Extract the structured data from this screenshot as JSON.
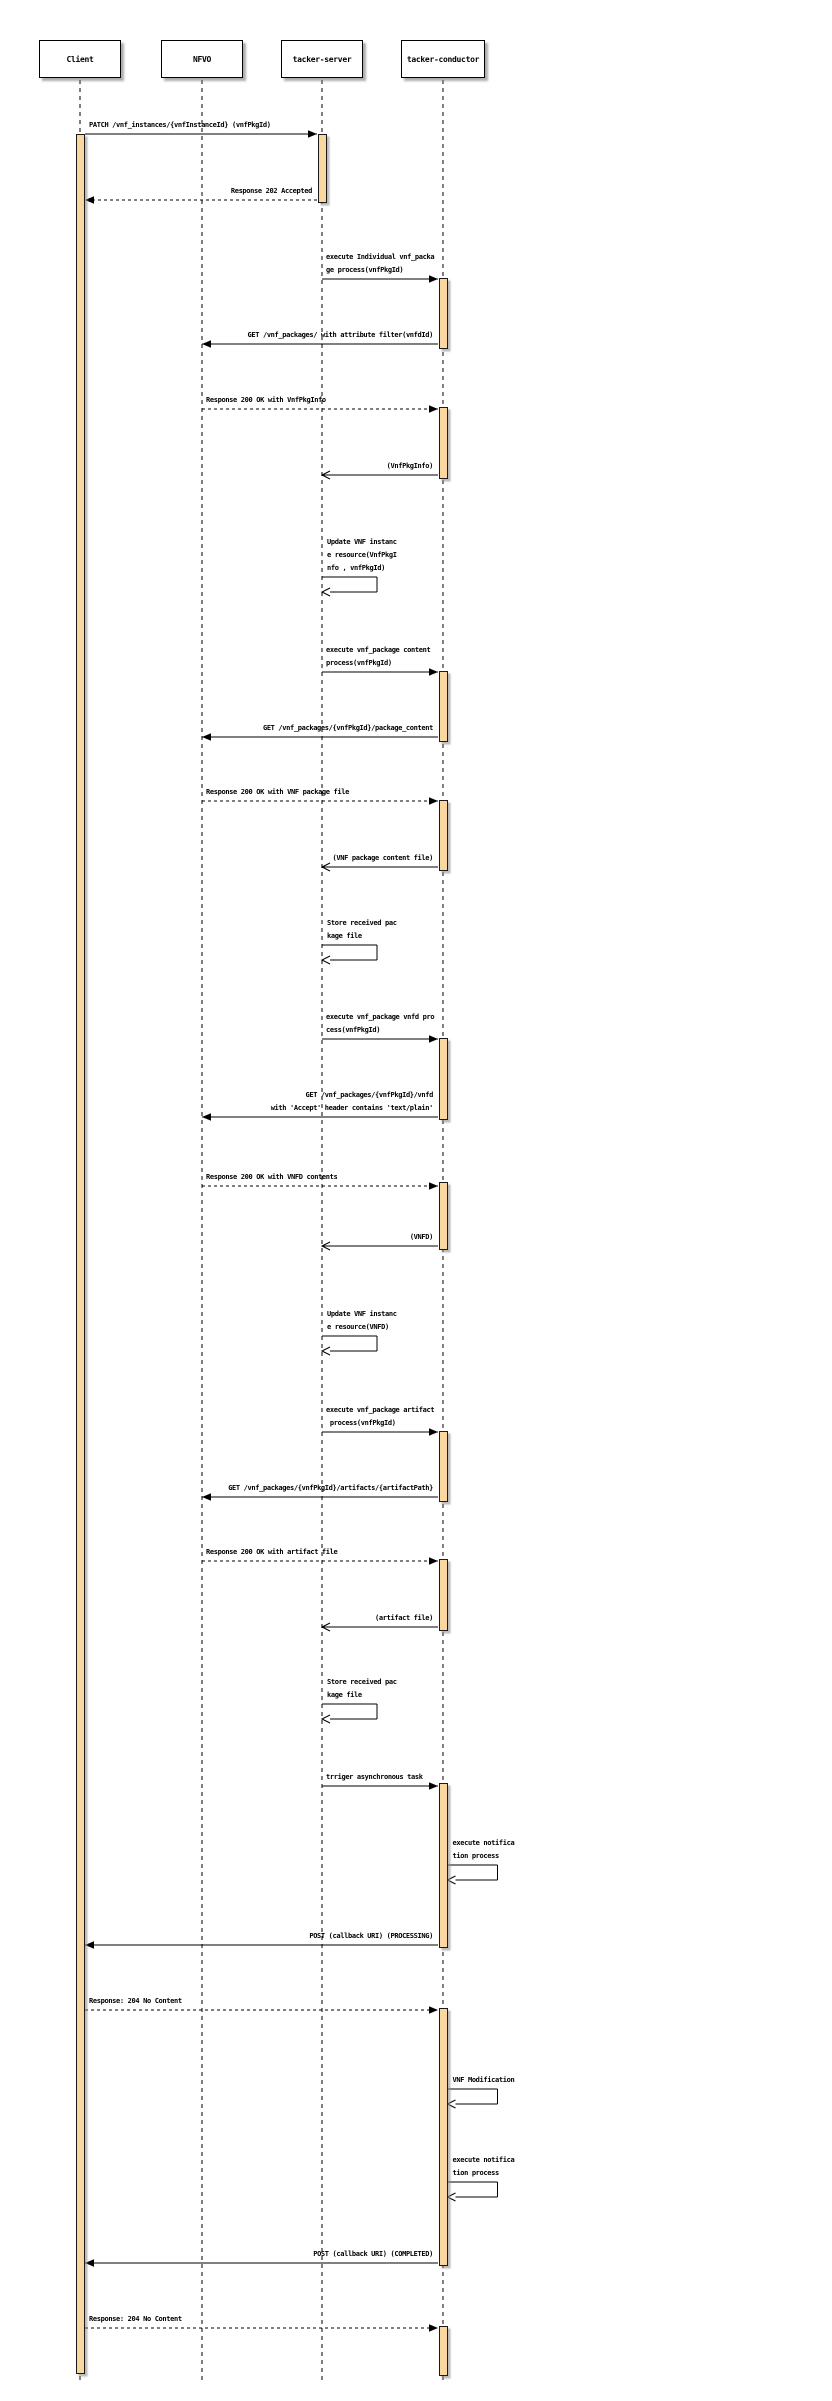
{
  "diagram": {
    "width": 832,
    "height": 2401,
    "colors": {
      "background": "#ffffff",
      "activation_fill": "#FAD7A0",
      "line": "#000000",
      "shadow": "#8a8a8a"
    },
    "lifeline_top": 80,
    "lifeline_bottom": 2381,
    "box_top": 40
  },
  "participants": [
    {
      "id": "client",
      "label": "Client",
      "x": 80,
      "box_w": 82
    },
    {
      "id": "nfvo",
      "label": "NFVO",
      "x": 202,
      "box_w": 82
    },
    {
      "id": "tacker-server",
      "label": "tacker-server",
      "x": 322,
      "box_w": 82
    },
    {
      "id": "tacker-conductor",
      "label": "tacker-conductor",
      "x": 443,
      "box_w": 84
    }
  ],
  "activations": [
    {
      "participant": "client",
      "from": 134,
      "to": 2374
    },
    {
      "participant": "tacker-server",
      "from": 134,
      "to": 203
    },
    {
      "participant": "tacker-conductor",
      "from": 278,
      "to": 349
    },
    {
      "participant": "tacker-conductor",
      "from": 407,
      "to": 479
    },
    {
      "participant": "tacker-conductor",
      "from": 671,
      "to": 742
    },
    {
      "participant": "tacker-conductor",
      "from": 800,
      "to": 871
    },
    {
      "participant": "tacker-conductor",
      "from": 1038,
      "to": 1120
    },
    {
      "participant": "tacker-conductor",
      "from": 1182,
      "to": 1250
    },
    {
      "participant": "tacker-conductor",
      "from": 1431,
      "to": 1502
    },
    {
      "participant": "tacker-conductor",
      "from": 1559,
      "to": 1631
    },
    {
      "participant": "tacker-conductor",
      "from": 1783,
      "to": 1948
    },
    {
      "participant": "tacker-conductor",
      "from": 2008,
      "to": 2266
    },
    {
      "participant": "tacker-conductor",
      "from": 2326,
      "to": 2376
    }
  ],
  "messages": [
    {
      "type": "solid",
      "from": "client",
      "to": "tacker-server",
      "y": 134,
      "lines": [
        "PATCH /vnf_instances/{vnfInstanceId} (vnfPkgId)"
      ]
    },
    {
      "type": "dashed",
      "from": "tacker-server",
      "to": "client",
      "y": 200,
      "lines": [
        "Response 202 Accepted"
      ]
    },
    {
      "type": "solid",
      "from": "tacker-server",
      "to": "tacker-conductor",
      "y": 279,
      "lines": [
        "execute Individual vnf_packa",
        "ge process(vnfPkgId)"
      ]
    },
    {
      "type": "solid",
      "from": "tacker-conductor",
      "to": "nfvo",
      "y": 344,
      "lines": [
        "GET /vnf_packages/ with attribute filter(vnfdId)"
      ]
    },
    {
      "type": "dashed",
      "from": "nfvo",
      "to": "tacker-conductor",
      "y": 409,
      "lines": [
        "Response 200 OK with VnfPkgInfo"
      ]
    },
    {
      "type": "return",
      "from": "tacker-conductor",
      "to": "tacker-server",
      "y": 475,
      "lines": [
        "(VnfPkgInfo)"
      ]
    },
    {
      "type": "self",
      "from": "tacker-server",
      "y": 577,
      "lines": [
        "Update VNF instanc",
        "e resource(VnfPkgI",
        "nfo , vnfPkgId)"
      ]
    },
    {
      "type": "solid",
      "from": "tacker-server",
      "to": "tacker-conductor",
      "y": 672,
      "lines": [
        "execute vnf_package content",
        "process(vnfPkgId)"
      ]
    },
    {
      "type": "solid",
      "from": "tacker-conductor",
      "to": "nfvo",
      "y": 737,
      "lines": [
        "GET /vnf_packages/{vnfPkgId}/package_content"
      ]
    },
    {
      "type": "dashed",
      "from": "nfvo",
      "to": "tacker-conductor",
      "y": 801,
      "lines": [
        "Response 200 OK with VNF package file"
      ]
    },
    {
      "type": "return",
      "from": "tacker-conductor",
      "to": "tacker-server",
      "y": 867,
      "lines": [
        "(VNF package content file)"
      ]
    },
    {
      "type": "self",
      "from": "tacker-server",
      "y": 945,
      "lines": [
        "Store received pac",
        "kage file"
      ]
    },
    {
      "type": "solid",
      "from": "tacker-server",
      "to": "tacker-conductor",
      "y": 1039,
      "lines": [
        "execute vnf_package vnfd pro",
        "cess(vnfPkgId)"
      ]
    },
    {
      "type": "solid",
      "from": "tacker-conductor",
      "to": "nfvo",
      "y": 1117,
      "lines": [
        "GET /vnf_packages/{vnfPkgId}/vnfd",
        "with 'Accept' header contains 'text/plain'"
      ]
    },
    {
      "type": "dashed",
      "from": "nfvo",
      "to": "tacker-conductor",
      "y": 1186,
      "lines": [
        "Response 200 OK with VNFD contents"
      ]
    },
    {
      "type": "return",
      "from": "tacker-conductor",
      "to": "tacker-server",
      "y": 1246,
      "lines": [
        "(VNFD)"
      ]
    },
    {
      "type": "self",
      "from": "tacker-server",
      "y": 1336,
      "lines": [
        "Update VNF instanc",
        "e resource(VNFD)"
      ]
    },
    {
      "type": "solid",
      "from": "tacker-server",
      "to": "tacker-conductor",
      "y": 1432,
      "lines": [
        "execute vnf_package artifact",
        " process(vnfPkgId)"
      ]
    },
    {
      "type": "solid",
      "from": "tacker-conductor",
      "to": "nfvo",
      "y": 1497,
      "lines": [
        "GET /vnf_packages/{vnfPkgId}/artifacts/{artifactPath}"
      ]
    },
    {
      "type": "dashed",
      "from": "nfvo",
      "to": "tacker-conductor",
      "y": 1561,
      "lines": [
        "Response 200 OK with artifact file"
      ]
    },
    {
      "type": "return",
      "from": "tacker-conductor",
      "to": "tacker-server",
      "y": 1627,
      "lines": [
        "(artifact file)"
      ]
    },
    {
      "type": "self",
      "from": "tacker-server",
      "y": 1704,
      "lines": [
        "Store received pac",
        "kage file"
      ]
    },
    {
      "type": "solid",
      "from": "tacker-server",
      "to": "tacker-conductor",
      "y": 1786,
      "lines": [
        "trriger asynchronous task"
      ]
    },
    {
      "type": "self",
      "from": "tacker-conductor",
      "y": 1865,
      "lines": [
        "execute notifica",
        "tion process"
      ]
    },
    {
      "type": "solid",
      "from": "tacker-conductor",
      "to": "client",
      "y": 1945,
      "lines": [
        "POST (callback URI) (PROCESSING)"
      ]
    },
    {
      "type": "dashed",
      "from": "client",
      "to": "tacker-conductor",
      "y": 2010,
      "lines": [
        "Response: 204 No Content"
      ]
    },
    {
      "type": "self",
      "from": "tacker-conductor",
      "y": 2089,
      "lines": [
        "VNF Modification"
      ]
    },
    {
      "type": "self",
      "from": "tacker-conductor",
      "y": 2182,
      "lines": [
        "execute notifica",
        "tion process"
      ]
    },
    {
      "type": "solid",
      "from": "tacker-conductor",
      "to": "client",
      "y": 2263,
      "lines": [
        "POST (callback URI) (COMPLETED)"
      ]
    },
    {
      "type": "dashed",
      "from": "client",
      "to": "tacker-conductor",
      "y": 2328,
      "lines": [
        "Response: 204 No Content"
      ]
    }
  ]
}
